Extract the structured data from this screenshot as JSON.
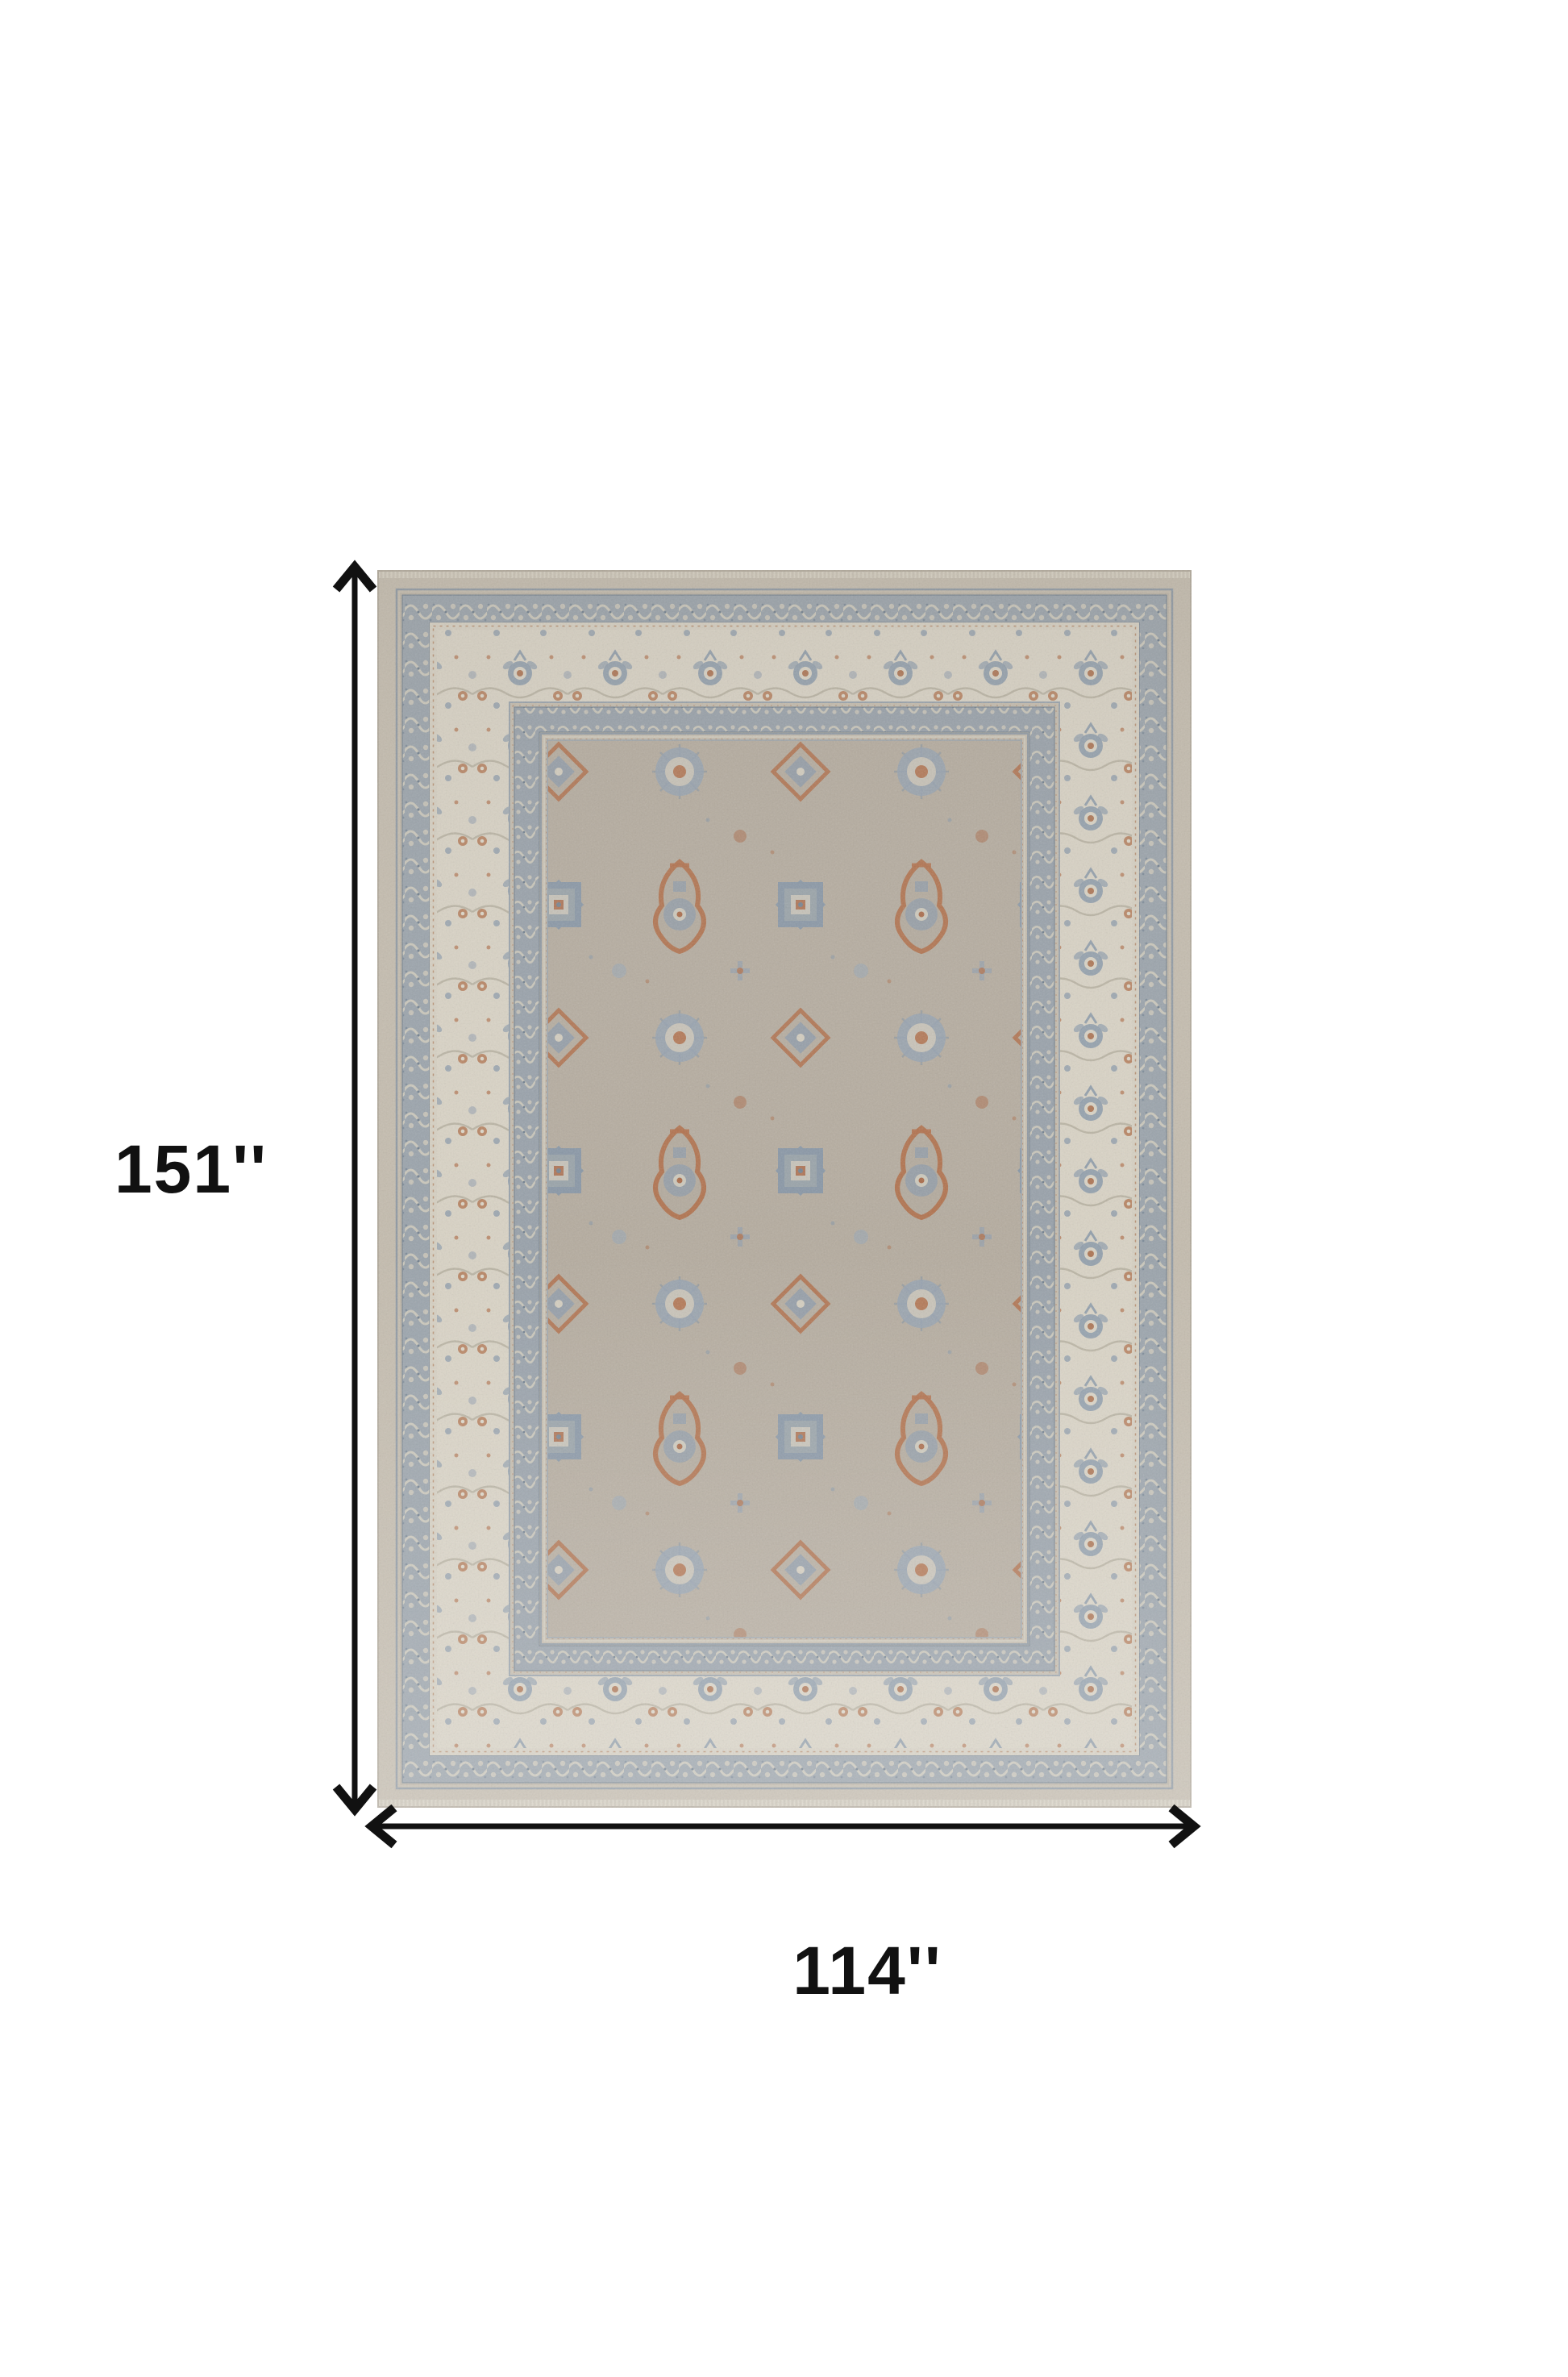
{
  "page": {
    "type": "product-dimension-diagram",
    "background": "#ffffff"
  },
  "product": {
    "name": "area-rug",
    "description": "Traditional oriental-style area rug with taupe field, ivory floral border, slate-blue scroll borders and rust medallion motifs"
  },
  "dimensions": {
    "height": {
      "label": "151''",
      "value_inches": 151
    },
    "width": {
      "label": "114''",
      "value_inches": 114
    }
  },
  "annotations": {
    "height_arrow": "double-headed-vertical-arrow",
    "width_arrow": "double-headed-horizontal-arrow"
  },
  "colors": {
    "annotation": "#111111",
    "page-bg": "#ffffff",
    "rug-band": "#c4bcae",
    "border-scroll-blue": "#9aa3ab",
    "border-cream": "#d9d3c5",
    "field-taupe": "#b5ac9f",
    "motif-rust": "#b1704b",
    "motif-slate-blue": "#8495a6",
    "pattern-cream": "#d0cbbd"
  }
}
